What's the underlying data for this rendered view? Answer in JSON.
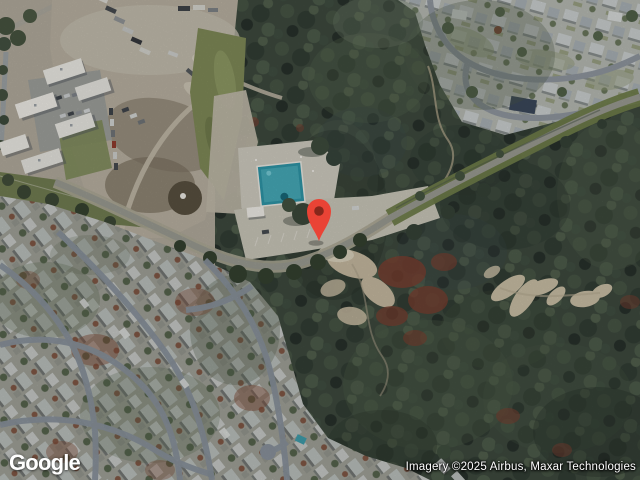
{
  "map": {
    "logo_text": "Google",
    "attribution": "Imagery ©2025 Airbus, Maxar Technologies",
    "marker": {
      "color": "#EA4335",
      "hole_color": "#87271B",
      "anchor_x": 319,
      "anchor_y": 241
    }
  }
}
